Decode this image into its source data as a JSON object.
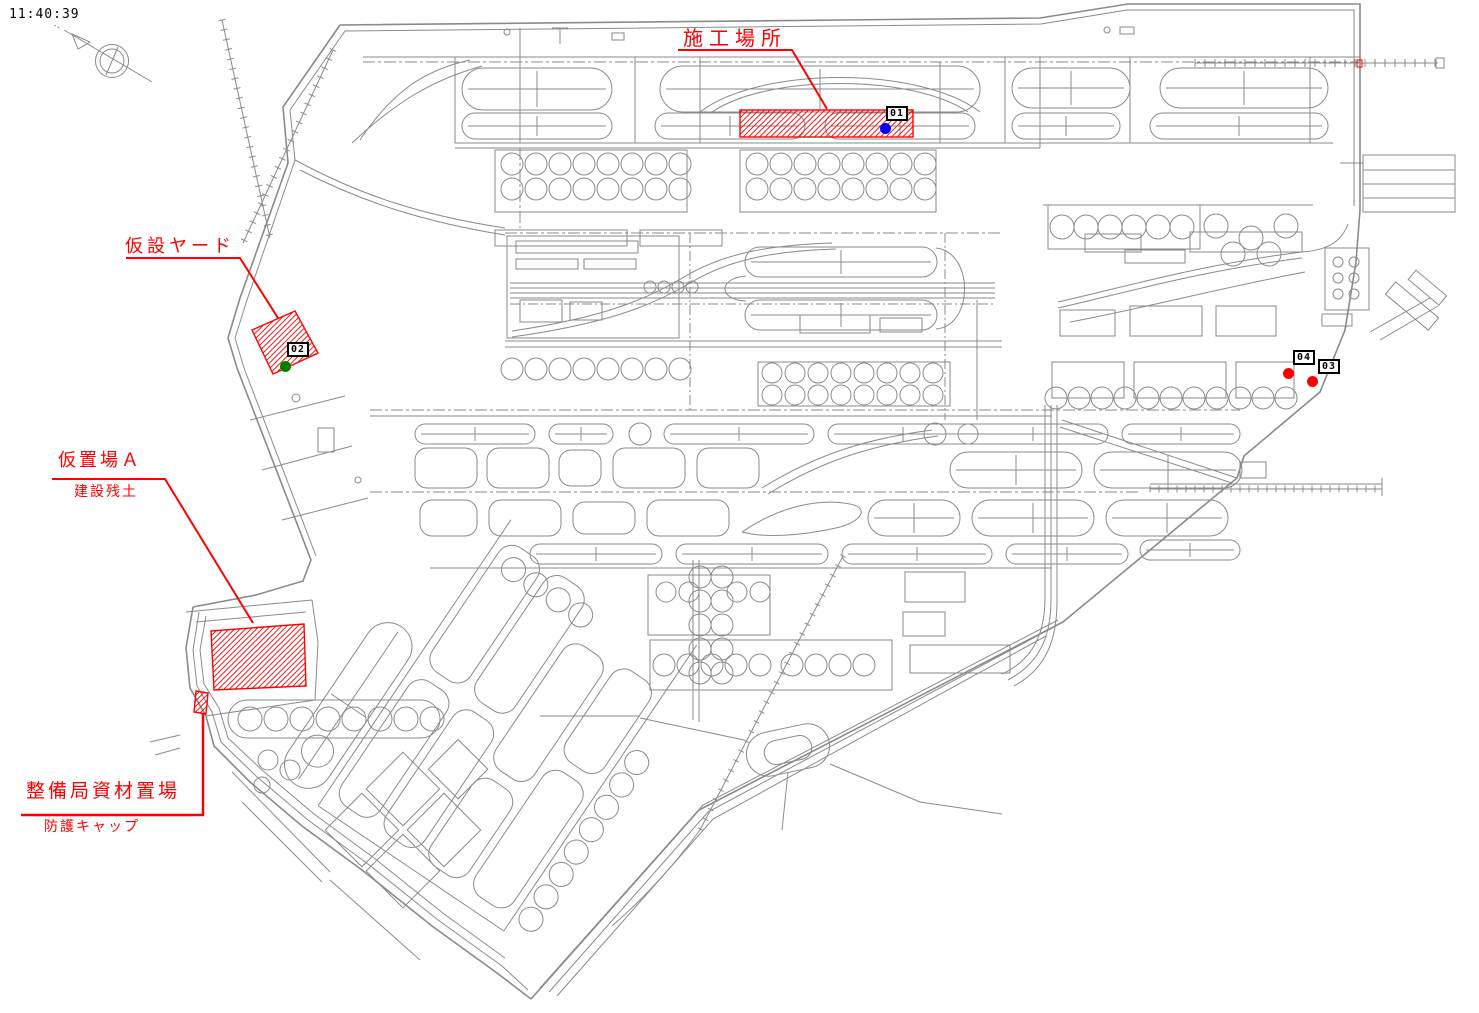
{
  "window": {
    "timestamp": "11:40:39"
  },
  "colors": {
    "annotation_red": "#ff0000",
    "drawing_gray": "#8a8a8a",
    "marker_01_dot": "#0000ff",
    "marker_02_dot": "#008000",
    "marker_03_dot": "#ff0000",
    "marker_04_dot": "#ff0000"
  },
  "annotations": {
    "construction_site": {
      "label": "施工場所"
    },
    "temporary_yard": {
      "label": "仮設ヤード"
    },
    "temporary_storage_a": {
      "label": "仮置場Ａ",
      "note": "建設残土"
    },
    "maintenance_bureau_storage": {
      "label": "整備局資材置場",
      "note": "防護キャップ"
    }
  },
  "markers": {
    "m01": {
      "id": "01"
    },
    "m02": {
      "id": "02"
    },
    "m03": {
      "id": "03"
    },
    "m04": {
      "id": "04"
    }
  }
}
